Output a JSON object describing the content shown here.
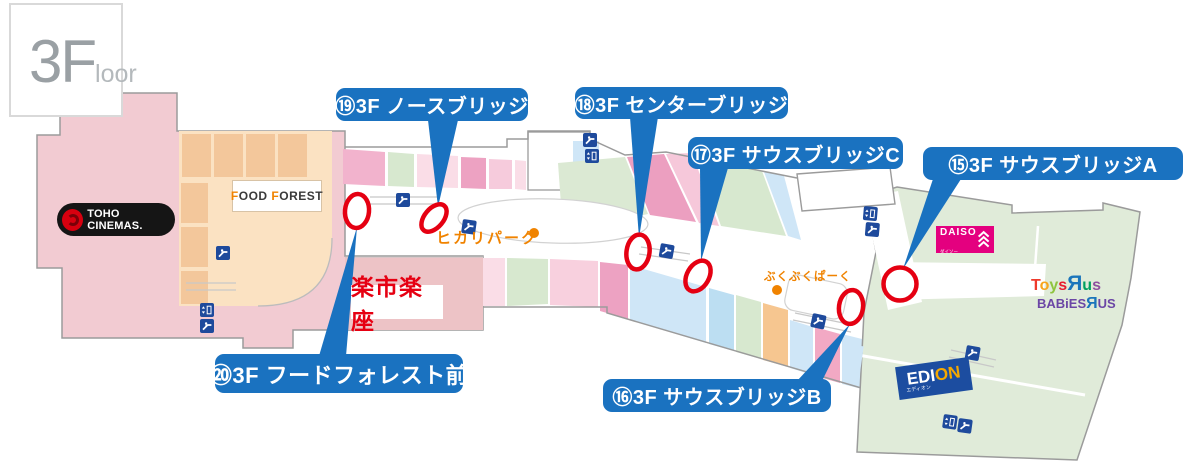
{
  "floor_badge": {
    "big": "3F",
    "small": "loor"
  },
  "banners": {
    "b15": "⑮3F サウスブリッジA",
    "b16": "⑯3F サウスブリッジB",
    "b17": "⑰3F サウスブリッジC",
    "b18": "⑱3F センターブリッジ",
    "b19": "⑲3F ノースブリッジ",
    "b20": "⑳3F フードフォレスト前"
  },
  "stores": {
    "toho_cinemas": "TOHO CINEMAS.",
    "food_forest": {
      "f1": "F",
      "ood": "OOD",
      "f2": "F",
      "orest": "OREST"
    },
    "rakuichi": "楽市楽座",
    "hikari_park": "ヒカリパーク",
    "bukubuku_park": "ぶくぶくぱーく",
    "daiso": {
      "name": "DAISO",
      "sub": "ダイソー"
    },
    "toysrus": {
      "letters": [
        "T",
        "o",
        "y",
        "s",
        "Я",
        "u",
        "s"
      ]
    },
    "babiesrus": {
      "b1": "BABiES",
      "r": "Я",
      "us": "US"
    },
    "edion": {
      "ed": "EDI",
      "on": "ON",
      "sub": "エディオン"
    }
  },
  "icons": {
    "escalator": "escalator-icon",
    "elevator": "elevator-icon"
  },
  "colors": {
    "banner_blue": "#1a72c0",
    "marker_red": "#e50012",
    "building_pink": "#f2cbd2",
    "building_tan": "#fbe2c2",
    "building_green": "#e0ebd9",
    "daiso_magenta": "#e4007f",
    "edion_blue": "#1c4da0",
    "park_orange": "#f08300",
    "icon_navy": "#1e4a9c"
  }
}
